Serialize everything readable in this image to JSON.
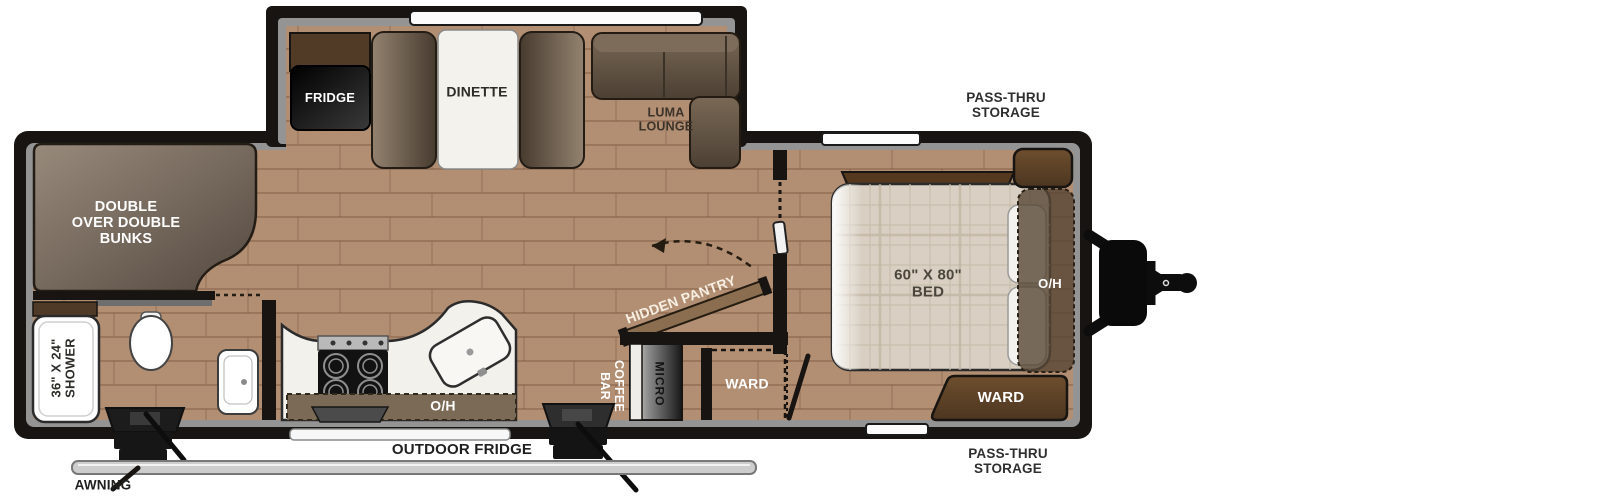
{
  "title": "Travel Trailer Floorplan",
  "colors": {
    "wall": "#171411",
    "inner_trim": "#949494",
    "floor": "#b28e73",
    "floor_line": "#8f6f55",
    "counter_white": "#f3f1ec",
    "cabinet_brown": "#5a4129",
    "furniture_taupe": "#5d5044",
    "oh_band": "#7b6a56",
    "mattress": "#d9d0c3",
    "awning_bar": "#cdcdcd",
    "window": "#fcfcfc"
  },
  "labels": {
    "bunks": "DOUBLE\nOVER DOUBLE\nBUNKS",
    "shower": "36\" X 24\"\nSHOWER",
    "fridge": "FRIDGE",
    "dinette": "DINETTE",
    "luma_lounge": "LUMA\nLOUNGE",
    "hidden_pantry": "HIDDEN PANTRY",
    "coffee_bar": "COFFEE\nBAR",
    "micro": "MICRO",
    "ward_hall": "WARD",
    "bed": "60\" X 80\"\nBED",
    "oh_kitchen": "O/H",
    "oh_bed": "O/H",
    "ward_bed": "WARD",
    "pass_thru_top": "PASS-THRU\nSTORAGE",
    "pass_thru_bottom": "PASS-THRU\nSTORAGE",
    "outdoor_fridge": "OUTDOOR FRIDGE",
    "awning": "AWNING"
  }
}
